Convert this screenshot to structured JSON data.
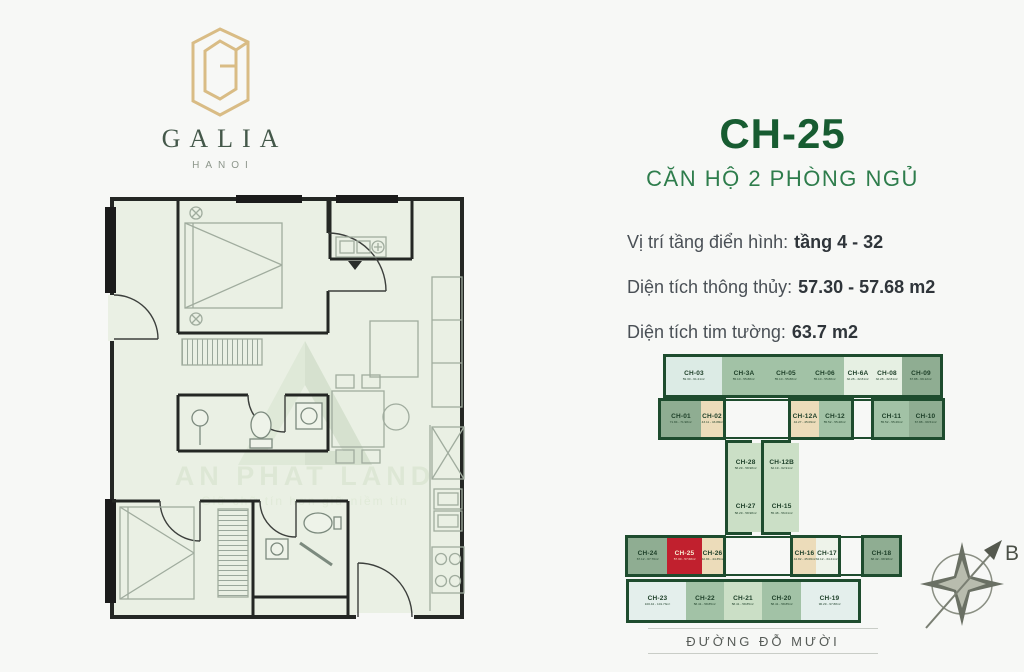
{
  "brand": {
    "name": "GALIA",
    "city": "HANOI"
  },
  "unit": {
    "code": "CH-25",
    "type_label": "CĂN HỘ 2 PHÒNG NGỦ",
    "specs": [
      {
        "label": "Vị trí tầng điển hình:",
        "value": "tầng 4 - 32"
      },
      {
        "label": "Diện tích thông thủy:",
        "value": "57.30 - 57.68 m2"
      },
      {
        "label": "Diện tích tim tường:",
        "value": "63.7 m2"
      }
    ]
  },
  "watermark": {
    "name": "AN PHAT LAND",
    "tagline": "Giữ chữ tín hơn giữ niềm tin"
  },
  "street_label": "ĐƯỜNG ĐỖ MƯỜI",
  "compass": {
    "north_label": "B"
  },
  "colors": {
    "accent_green": "#175c31",
    "subtitle_green": "#2e7d4c",
    "keyplan_outline": "#1e4c2e",
    "highlight_red": "#c1202e",
    "logo_gold": "#d9bc85",
    "plan_fill": "#eaf0e4"
  },
  "keyplan": {
    "highlighted_unit": "CH-25",
    "blocks": {
      "top_row": [
        {
          "code": "CH-03",
          "area": "59.30 - 61.21m²",
          "fill": "#dcebe5"
        },
        {
          "code": "CH-3A",
          "area": "55.10 - 55.88m²",
          "fill": "#a2c2a6"
        },
        {
          "code": "CH-05",
          "area": "55.10 - 55.88m²",
          "fill": "#a2c2a6"
        },
        {
          "code": "CH-06",
          "area": "55.10 - 55.88m²",
          "fill": "#a2c2a6"
        },
        {
          "code": "CH-6A",
          "area": "32.28 - 32.81m²",
          "fill": "#e6f0e3"
        },
        {
          "code": "CH-08",
          "area": "32.28 - 32.81m²",
          "fill": "#e6f0e3"
        },
        {
          "code": "CH-09",
          "area": "67.88 - 69.12m²",
          "fill": "#8fad92"
        }
      ],
      "row2_left": [
        {
          "code": "CH-01",
          "area": "71.84 - 71.98m²",
          "fill": "#8fad92"
        },
        {
          "code": "CH-02",
          "area": "43.11 - 43.88m²",
          "fill": "#ecdcba"
        }
      ],
      "row2_mid": [
        {
          "code": "CH-12A",
          "area": "44.27 - 45.09m²",
          "fill": "#ecdcba"
        },
        {
          "code": "CH-12",
          "area": "55.52 - 55.28m²",
          "fill": "#a2c2a6"
        }
      ],
      "row2_right": [
        {
          "code": "CH-11",
          "area": "55.52 - 55.26m²",
          "fill": "#a2c2a6"
        },
        {
          "code": "CH-10",
          "area": "67.88 - 69.51m²",
          "fill": "#8fad92"
        }
      ],
      "core_left": [
        {
          "code": "CH-28",
          "area": "58.29 - 58.98m²",
          "fill": "#cbdfc6"
        },
        {
          "code": "CH-27",
          "area": "58.29 - 58.98m²",
          "fill": "#cbdfc6"
        }
      ],
      "core_right": [
        {
          "code": "CH-12B",
          "area": "62.19 - 62.91m²",
          "fill": "#cbdfc6"
        },
        {
          "code": "CH-15",
          "area": "55.48 - 56.01m²",
          "fill": "#cbdfc6"
        }
      ],
      "row3_left": [
        {
          "code": "CH-24",
          "area": "67.12 - 67.76m²",
          "fill": "#8fad92"
        },
        {
          "code": "CH-25",
          "area": "57.30 - 57.68m²",
          "fill": "#c1202e",
          "text": "#f8eed3"
        },
        {
          "code": "CH-26",
          "area": "42.84 - 44.35m²",
          "fill": "#ecdcba"
        }
      ],
      "row3_mid": [
        {
          "code": "CH-16",
          "area": "44.82 - 45.06m²",
          "fill": "#ecdcba"
        },
        {
          "code": "CH-17",
          "area": "34.12 - 34.41m²",
          "fill": "#eef3ea"
        }
      ],
      "row3_right": [
        {
          "code": "CH-18",
          "area": "68.42 - 68.98m²",
          "fill": "#8fad92"
        }
      ],
      "row4": [
        {
          "code": "CH-23",
          "area": "100.42 - 101.73m²",
          "fill": "#e4efec"
        },
        {
          "code": "CH-22",
          "area": "58.41 - 58.85m²",
          "fill": "#a2c2a6"
        },
        {
          "code": "CH-21",
          "area": "58.41 - 58.85m²",
          "fill": "#cbdfc6"
        },
        {
          "code": "CH-20",
          "area": "58.41 - 58.85m²",
          "fill": "#a2c2a6"
        },
        {
          "code": "CH-19",
          "area": "96.29 - 97.88m²",
          "fill": "#e4efec"
        }
      ]
    }
  }
}
